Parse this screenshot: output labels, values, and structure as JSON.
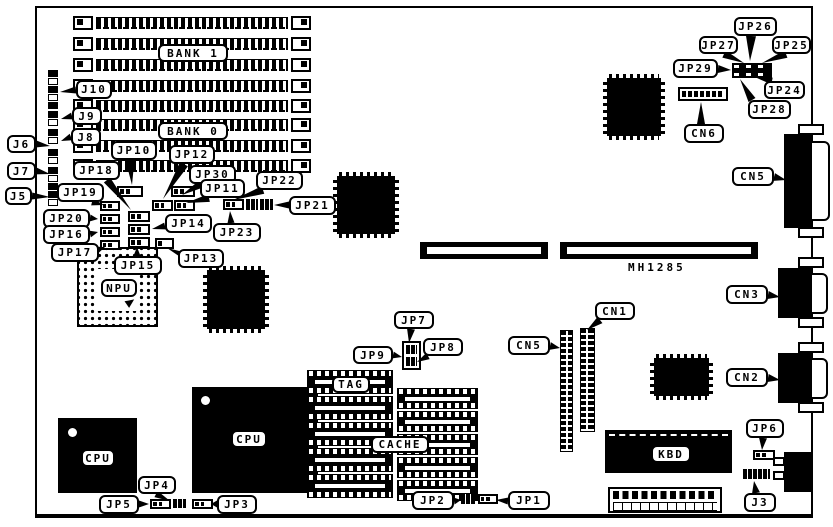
{
  "diagram": {
    "background": "#ffffff",
    "ink": "#000000",
    "board": {
      "x": 35,
      "y": 6,
      "w": 778,
      "h": 512
    },
    "static_texts": [
      {
        "id": "board-part-number",
        "text": "MH1285",
        "x": 628,
        "y": 261
      }
    ],
    "callouts": [
      {
        "id": "label-bank1",
        "text": "BANK 1",
        "x": 158,
        "y": 44,
        "w": 70,
        "h": 18,
        "tail": null
      },
      {
        "id": "label-bank0",
        "text": "BANK 0",
        "x": 158,
        "y": 122,
        "w": 70,
        "h": 18,
        "tail": null
      },
      {
        "id": "label-j10",
        "text": "J10",
        "x": 76,
        "y": 80,
        "w": 36,
        "h": 19,
        "tail": [
          76,
          90,
          60,
          92,
          7
        ]
      },
      {
        "id": "label-j9",
        "text": "J9",
        "x": 72,
        "y": 107,
        "w": 30,
        "h": 18,
        "tail": [
          72,
          116,
          61,
          119,
          7
        ]
      },
      {
        "id": "label-j8",
        "text": "J8",
        "x": 71,
        "y": 128,
        "w": 30,
        "h": 18,
        "tail": [
          71,
          137,
          61,
          141,
          7
        ]
      },
      {
        "id": "label-j6",
        "text": "J6",
        "x": 7,
        "y": 135,
        "w": 29,
        "h": 18,
        "tail": [
          36,
          144,
          50,
          146,
          7
        ]
      },
      {
        "id": "label-j7",
        "text": "J7",
        "x": 7,
        "y": 162,
        "w": 29,
        "h": 18,
        "tail": [
          36,
          171,
          50,
          174,
          7
        ]
      },
      {
        "id": "label-j5",
        "text": "J5",
        "x": 5,
        "y": 187,
        "w": 27,
        "h": 18,
        "tail": [
          32,
          196,
          50,
          197,
          7
        ]
      },
      {
        "id": "label-jp10",
        "text": "JP10",
        "x": 111,
        "y": 141,
        "w": 46,
        "h": 19,
        "tail": [
          130,
          160,
          132,
          185,
          9
        ]
      },
      {
        "id": "label-jp12",
        "text": "JP12",
        "x": 169,
        "y": 145,
        "w": 46,
        "h": 19,
        "tail": [
          184,
          164,
          163,
          199,
          9
        ]
      },
      {
        "id": "label-jp18",
        "text": "JP18",
        "x": 73,
        "y": 161,
        "w": 47,
        "h": 19,
        "tail": [
          107,
          180,
          131,
          210,
          8
        ]
      },
      {
        "id": "label-jp30",
        "text": "JP30",
        "x": 189,
        "y": 165,
        "w": 47,
        "h": 19,
        "tail": [
          201,
          184,
          182,
          195,
          8
        ]
      },
      {
        "id": "label-jp19",
        "text": "JP19",
        "x": 57,
        "y": 183,
        "w": 47,
        "h": 19,
        "tail": [
          92,
          202,
          104,
          205,
          7
        ]
      },
      {
        "id": "label-jp11",
        "text": "JP11",
        "x": 200,
        "y": 179,
        "w": 45,
        "h": 19,
        "tail": [
          209,
          198,
          186,
          203,
          8
        ]
      },
      {
        "id": "label-jp22",
        "text": "JP22",
        "x": 256,
        "y": 171,
        "w": 47,
        "h": 19,
        "tail": [
          263,
          190,
          233,
          200,
          8
        ]
      },
      {
        "id": "label-jp21",
        "text": "JP21",
        "x": 289,
        "y": 196,
        "w": 47,
        "h": 19,
        "tail": [
          289,
          205,
          274,
          205,
          7
        ]
      },
      {
        "id": "label-jp20",
        "text": "JP20",
        "x": 43,
        "y": 209,
        "w": 47,
        "h": 19,
        "tail": [
          90,
          218,
          98,
          219,
          7
        ]
      },
      {
        "id": "label-jp16",
        "text": "JP16",
        "x": 43,
        "y": 225,
        "w": 47,
        "h": 19,
        "tail": [
          90,
          234,
          98,
          232,
          7
        ]
      },
      {
        "id": "label-jp14",
        "text": "JP14",
        "x": 165,
        "y": 214,
        "w": 47,
        "h": 19,
        "tail": [
          165,
          226,
          152,
          229,
          7
        ]
      },
      {
        "id": "label-jp23",
        "text": "JP23",
        "x": 213,
        "y": 223,
        "w": 48,
        "h": 19,
        "tail": [
          231,
          223,
          230,
          211,
          7
        ]
      },
      {
        "id": "label-jp17",
        "text": "JP17",
        "x": 51,
        "y": 243,
        "w": 48,
        "h": 19,
        "tail": [
          97,
          250,
          105,
          247,
          7
        ]
      },
      {
        "id": "label-jp15",
        "text": "JP15",
        "x": 114,
        "y": 256,
        "w": 48,
        "h": 19,
        "tail": [
          137,
          256,
          137,
          247,
          7
        ]
      },
      {
        "id": "label-jp13",
        "text": "JP13",
        "x": 178,
        "y": 249,
        "w": 46,
        "h": 19,
        "tail": [
          185,
          256,
          167,
          248,
          7
        ]
      },
      {
        "id": "label-npu",
        "text": "NPU",
        "x": 101,
        "y": 279,
        "w": 36,
        "h": 18,
        "tail": null
      },
      {
        "id": "label-jp26",
        "text": "JP26",
        "x": 734,
        "y": 17,
        "w": 43,
        "h": 19,
        "tail": [
          751,
          36,
          750,
          61,
          10
        ]
      },
      {
        "id": "label-jp27",
        "text": "JP27",
        "x": 699,
        "y": 36,
        "w": 39,
        "h": 18,
        "tail": [
          724,
          54,
          744,
          63,
          8
        ]
      },
      {
        "id": "label-jp25",
        "text": "JP25",
        "x": 772,
        "y": 36,
        "w": 39,
        "h": 18,
        "tail": [
          786,
          54,
          762,
          63,
          8
        ]
      },
      {
        "id": "label-jp29",
        "text": "JP29",
        "x": 673,
        "y": 59,
        "w": 45,
        "h": 19,
        "tail": [
          718,
          69,
          731,
          70,
          8
        ]
      },
      {
        "id": "label-jp24",
        "text": "JP24",
        "x": 764,
        "y": 81,
        "w": 41,
        "h": 18,
        "tail": [
          772,
          81,
          757,
          78,
          7
        ]
      },
      {
        "id": "label-jp28",
        "text": "JP28",
        "x": 748,
        "y": 100,
        "w": 43,
        "h": 19,
        "tail": [
          752,
          100,
          740,
          79,
          8
        ]
      },
      {
        "id": "label-cn6",
        "text": "CN6",
        "x": 684,
        "y": 124,
        "w": 40,
        "h": 19,
        "tail": [
          701,
          124,
          701,
          102,
          8
        ]
      },
      {
        "id": "label-cn5-rear",
        "text": "CN5",
        "x": 732,
        "y": 167,
        "w": 42,
        "h": 19,
        "tail": [
          774,
          177,
          786,
          180,
          8
        ]
      },
      {
        "id": "label-cn3",
        "text": "CN3",
        "x": 726,
        "y": 285,
        "w": 42,
        "h": 19,
        "tail": [
          768,
          295,
          780,
          297,
          8
        ]
      },
      {
        "id": "label-cn2",
        "text": "CN2",
        "x": 726,
        "y": 368,
        "w": 42,
        "h": 19,
        "tail": [
          768,
          378,
          780,
          380,
          8
        ]
      },
      {
        "id": "label-cn1",
        "text": "CN1",
        "x": 595,
        "y": 302,
        "w": 40,
        "h": 18,
        "tail": [
          600,
          320,
          587,
          330,
          8
        ]
      },
      {
        "id": "label-cn5-header",
        "text": "CN5",
        "x": 508,
        "y": 336,
        "w": 42,
        "h": 19,
        "tail": [
          550,
          346,
          560,
          348,
          8
        ]
      },
      {
        "id": "label-jp7",
        "text": "JP7",
        "x": 394,
        "y": 311,
        "w": 40,
        "h": 18,
        "tail": [
          411,
          329,
          409,
          343,
          8
        ]
      },
      {
        "id": "label-jp9",
        "text": "JP9",
        "x": 353,
        "y": 346,
        "w": 40,
        "h": 18,
        "tail": [
          393,
          355,
          402,
          357,
          7
        ]
      },
      {
        "id": "label-jp8",
        "text": "JP8",
        "x": 423,
        "y": 338,
        "w": 40,
        "h": 18,
        "tail": [
          428,
          356,
          417,
          362,
          7
        ]
      },
      {
        "id": "label-tag",
        "text": "TAG",
        "x": 332,
        "y": 376,
        "w": 38,
        "h": 17,
        "tail": null
      },
      {
        "id": "label-cache",
        "text": "CACHE",
        "x": 371,
        "y": 436,
        "w": 58,
        "h": 17,
        "tail": null
      },
      {
        "id": "label-cpu-left",
        "text": "CPU",
        "x": 81,
        "y": 449,
        "w": 34,
        "h": 18,
        "tail": null
      },
      {
        "id": "label-cpu-right",
        "text": "CPU",
        "x": 231,
        "y": 430,
        "w": 36,
        "h": 18,
        "tail": null
      },
      {
        "id": "label-kbd",
        "text": "KBD",
        "x": 651,
        "y": 445,
        "w": 40,
        "h": 18,
        "tail": null
      },
      {
        "id": "label-jp6",
        "text": "JP6",
        "x": 746,
        "y": 419,
        "w": 38,
        "h": 19,
        "tail": [
          763,
          438,
          762,
          450,
          8
        ]
      },
      {
        "id": "label-j3",
        "text": "J3",
        "x": 744,
        "y": 493,
        "w": 32,
        "h": 19,
        "tail": [
          756,
          493,
          754,
          481,
          8
        ]
      },
      {
        "id": "label-jp5",
        "text": "JP5",
        "x": 99,
        "y": 495,
        "w": 40,
        "h": 19,
        "tail": [
          139,
          504,
          149,
          504,
          7
        ]
      },
      {
        "id": "label-jp4",
        "text": "JP4",
        "x": 138,
        "y": 476,
        "w": 38,
        "h": 18,
        "tail": [
          156,
          494,
          170,
          501,
          7
        ]
      },
      {
        "id": "label-jp3",
        "text": "JP3",
        "x": 217,
        "y": 495,
        "w": 40,
        "h": 19,
        "tail": [
          217,
          504,
          211,
          504,
          7
        ]
      },
      {
        "id": "label-jp2",
        "text": "JP2",
        "x": 412,
        "y": 491,
        "w": 42,
        "h": 19,
        "tail": [
          454,
          501,
          461,
          500,
          7
        ]
      },
      {
        "id": "label-jp1",
        "text": "JP1",
        "x": 508,
        "y": 491,
        "w": 42,
        "h": 19,
        "tail": [
          508,
          501,
          496,
          500,
          7
        ]
      }
    ],
    "simm_bank": {
      "x": 73,
      "w": 238,
      "row_h": 16,
      "rows": [
        16,
        37,
        58,
        79,
        99,
        118,
        139,
        159
      ]
    },
    "left_strip": {
      "x": 48,
      "w": 10,
      "sq": 8,
      "segments": [
        {
          "y": 70,
          "n": 5
        },
        {
          "y": 111,
          "n": 2
        },
        {
          "y": 129,
          "n": 2
        },
        {
          "y": 149,
          "n": 2
        },
        {
          "y": 167,
          "n": 3
        },
        {
          "y": 191,
          "n": 2
        }
      ]
    },
    "qfp_chips": [
      {
        "id": "qfp-chip-1",
        "x": 203,
        "y": 266,
        "w": 66,
        "h": 67
      },
      {
        "id": "qfp-chip-2",
        "x": 333,
        "y": 172,
        "w": 66,
        "h": 66
      },
      {
        "id": "qfp-chip-3",
        "x": 603,
        "y": 74,
        "w": 62,
        "h": 66
      },
      {
        "id": "qfp-chip-4",
        "x": 650,
        "y": 354,
        "w": 63,
        "h": 46
      }
    ],
    "npu_socket": {
      "x": 77,
      "y": 247,
      "w": 81,
      "h": 80,
      "center": [
        97,
        269,
        42,
        42
      ],
      "arrow": [
        126,
        298
      ]
    },
    "cpu_chips": [
      {
        "id": "cpu-chip-left",
        "x": 58,
        "y": 418,
        "w": 79,
        "h": 75,
        "dot": [
          68,
          428
        ]
      },
      {
        "id": "cpu-chip-right",
        "x": 192,
        "y": 387,
        "w": 126,
        "h": 106,
        "dot": [
          201,
          396
        ]
      }
    ],
    "isa_slots": [
      {
        "id": "isa-slot-1",
        "x": 420,
        "y": 242,
        "w": 128,
        "h": 17
      },
      {
        "id": "isa-slot-2",
        "x": 560,
        "y": 242,
        "w": 198,
        "h": 17
      }
    ],
    "kbd_chip": {
      "x": 605,
      "y": 430,
      "w": 127,
      "h": 43
    },
    "power_connector": {
      "x": 608,
      "y": 487,
      "w": 114,
      "h": 26
    },
    "pin_headers": [
      {
        "id": "cn5-pin-header",
        "x": 560,
        "y": 330,
        "w": 13,
        "h": 122
      },
      {
        "id": "cn1-pin-header",
        "x": 580,
        "y": 328,
        "w": 15,
        "h": 104
      }
    ],
    "dip_columns": [
      {
        "id": "tag-sram-column",
        "x": 307,
        "y": 370,
        "w": 86,
        "n": 5,
        "sh": 24,
        "gap": 2
      },
      {
        "id": "cache-sram-column",
        "x": 397,
        "y": 388,
        "w": 81,
        "n": 5,
        "sh": 21,
        "gap": 2
      }
    ],
    "jp24_29_block": {
      "x": 732,
      "y": 63,
      "w": 40,
      "h": 15
    },
    "cn6_header": {
      "x": 678,
      "y": 87,
      "w": 50,
      "h": 14
    },
    "jp789_block": {
      "x": 402,
      "y": 341,
      "w": 19,
      "h": 29
    },
    "jumpers": [
      {
        "x": 117,
        "y": 186,
        "w": 26,
        "h": 11,
        "pins": 3,
        "style": "outline"
      },
      {
        "x": 171,
        "y": 186,
        "w": 24,
        "h": 11,
        "pins": 3,
        "style": "outline"
      },
      {
        "x": 152,
        "y": 200,
        "w": 21,
        "h": 11,
        "pins": 3,
        "style": "outline"
      },
      {
        "x": 174,
        "y": 200,
        "w": 21,
        "h": 11,
        "pins": 3,
        "style": "outline"
      },
      {
        "x": 223,
        "y": 199,
        "w": 21,
        "h": 11,
        "pins": 3,
        "style": "outline"
      },
      {
        "x": 246,
        "y": 199,
        "w": 12,
        "h": 11,
        "pins": 2,
        "style": "solid"
      },
      {
        "x": 260,
        "y": 199,
        "w": 13,
        "h": 11,
        "pins": 2,
        "style": "solid"
      },
      {
        "x": 100,
        "y": 201,
        "w": 20,
        "h": 10,
        "pins": 3,
        "style": "outline"
      },
      {
        "x": 100,
        "y": 214,
        "w": 20,
        "h": 10,
        "pins": 3,
        "style": "outline"
      },
      {
        "x": 100,
        "y": 227,
        "w": 20,
        "h": 10,
        "pins": 3,
        "style": "outline"
      },
      {
        "x": 100,
        "y": 240,
        "w": 20,
        "h": 10,
        "pins": 3,
        "style": "outline"
      },
      {
        "x": 128,
        "y": 211,
        "w": 22,
        "h": 11,
        "pins": 3,
        "style": "outline"
      },
      {
        "x": 128,
        "y": 224,
        "w": 22,
        "h": 11,
        "pins": 3,
        "style": "outline"
      },
      {
        "x": 128,
        "y": 237,
        "w": 22,
        "h": 11,
        "pins": 3,
        "style": "outline"
      },
      {
        "x": 155,
        "y": 238,
        "w": 19,
        "h": 11,
        "pins": 2,
        "style": "outline"
      },
      {
        "x": 753,
        "y": 450,
        "w": 22,
        "h": 10,
        "pins": 3,
        "style": "outline"
      },
      {
        "x": 743,
        "y": 469,
        "w": 27,
        "h": 10,
        "pins": 5,
        "style": "solid"
      },
      {
        "x": 150,
        "y": 499,
        "w": 21,
        "h": 10,
        "pins": 3,
        "style": "outline"
      },
      {
        "x": 173,
        "y": 499,
        "w": 13,
        "h": 9,
        "pins": 2,
        "style": "solid"
      },
      {
        "x": 192,
        "y": 499,
        "w": 21,
        "h": 10,
        "pins": 3,
        "style": "outline"
      },
      {
        "x": 461,
        "y": 494,
        "w": 14,
        "h": 10,
        "pins": 2,
        "style": "solid"
      },
      {
        "x": 478,
        "y": 494,
        "w": 20,
        "h": 10,
        "pins": 3,
        "style": "outline"
      }
    ],
    "edge_connectors": [
      {
        "id": "cn5-rear-connector",
        "body": [
          784,
          134,
          28,
          94
        ],
        "shell": [
          810,
          141,
          20,
          80
        ],
        "tabs": [
          [
            798,
            124,
            26,
            11
          ],
          [
            798,
            227,
            26,
            11
          ]
        ]
      },
      {
        "id": "cn3-rear-connector",
        "body": [
          778,
          268,
          34,
          50
        ],
        "shell": [
          810,
          273,
          18,
          41
        ],
        "tabs": [
          [
            798,
            257,
            26,
            11
          ],
          [
            798,
            317,
            26,
            11
          ]
        ]
      },
      {
        "id": "cn2-rear-connector",
        "body": [
          778,
          353,
          34,
          50
        ],
        "shell": [
          810,
          358,
          18,
          41
        ],
        "tabs": [
          [
            798,
            342,
            26,
            11
          ],
          [
            798,
            402,
            26,
            11
          ]
        ]
      },
      {
        "id": "kbd-din-connector",
        "body": [
          784,
          452,
          28,
          40
        ],
        "shell": null,
        "tabs": [
          [
            773,
            457,
            12,
            9
          ],
          [
            773,
            471,
            12,
            9
          ]
        ]
      }
    ]
  }
}
